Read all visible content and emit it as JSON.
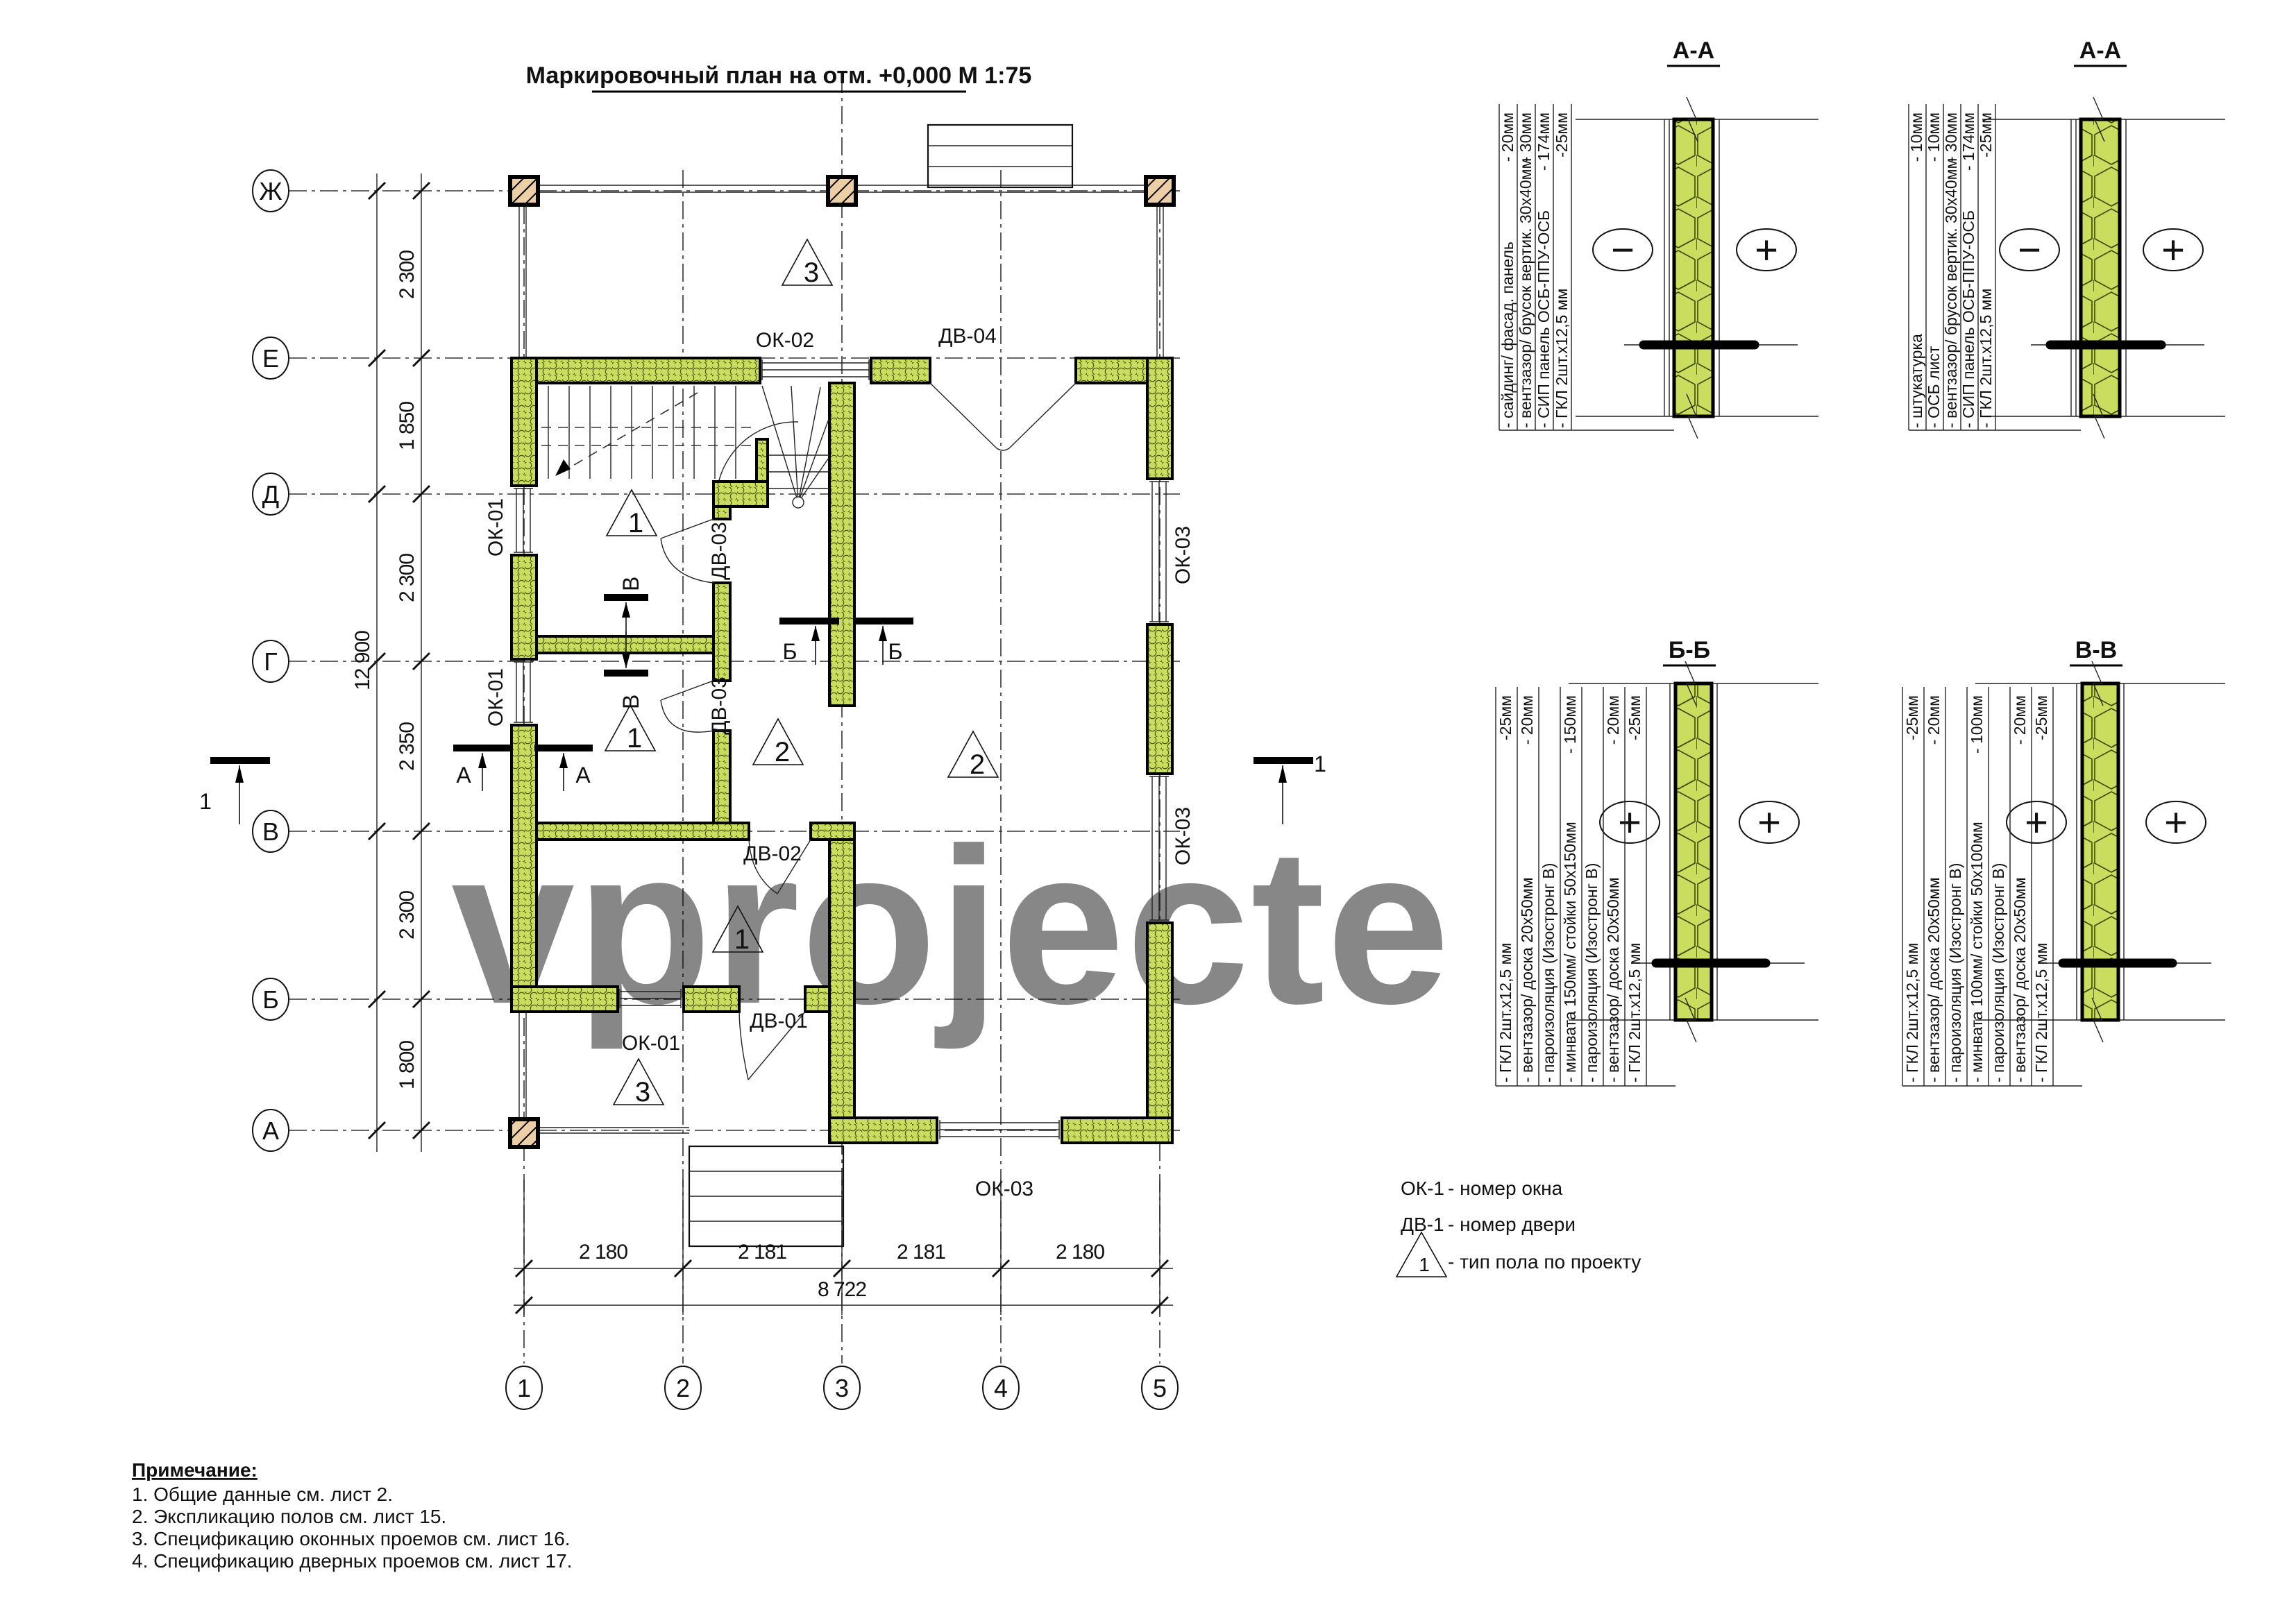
{
  "title": "Маркировочный план на отм. +0,000 М 1:75",
  "watermark": "vprojecte",
  "colors": {
    "wall_green": "#cbdd5e",
    "wall_hatch": "#44520a",
    "label_blue": "#7079b0",
    "wood_tan": "#eccfa6",
    "watermark_gray": "#cdcdcd"
  },
  "plan": {
    "axis_letters": [
      "Ж",
      "Е",
      "Д",
      "Г",
      "В",
      "Б",
      "А"
    ],
    "axis_numbers": [
      "1",
      "2",
      "3",
      "4",
      "5"
    ],
    "dims_left": [
      "2 300",
      "1 850",
      "2 300",
      "2 350",
      "2 300",
      "1 800"
    ],
    "dim_left_total": "12 900",
    "dims_bottom": [
      "2 180",
      "2 181",
      "2 181",
      "2 180"
    ],
    "dim_bottom_total": "8 722",
    "openings": {
      "ok02": "ОК-02",
      "dv04": "ДВ-04",
      "ok01_top": "ОК-01",
      "ok01_mid": "ОК-01",
      "ok01_bottom": "ОК-01",
      "dv03_top": "ДВ-03",
      "dv03_bottom": "ДВ-03",
      "ok03_top": "ОК-03",
      "ok03_mid": "ОК-03",
      "ok03_bottom": "ОК-03",
      "dv02": "ДВ-02",
      "dv01": "ДВ-01"
    },
    "floor_markers": {
      "porch_top": "3",
      "room_nw": "1",
      "room_w": "1",
      "room_mid": "2",
      "hall": "1",
      "room_e": "2",
      "porch_bottom": "3"
    },
    "section_cut_labels": {
      "v_upper": "В",
      "v_lower": "В",
      "b_left": "Б",
      "b_right": "Б",
      "a_left": "А",
      "a_right": "А",
      "one_left": "1",
      "one_right": "1"
    }
  },
  "sections": [
    {
      "title": "А-А",
      "sign_left": "−",
      "sign_right": "+",
      "layers": [
        {
          "name": "- сайдинг/ фасад. панель",
          "value": "- 20мм"
        },
        {
          "name": "- вентзазор/ брусок вертик. 30х40мм",
          "value": "- 30мм"
        },
        {
          "name": "- СИП панель ОСБ-ППУ-ОСБ",
          "value": "- 174мм"
        },
        {
          "name": "- ГКЛ 2шт.х12,5 мм",
          "value": "-25мм"
        }
      ]
    },
    {
      "title": "А-А",
      "sign_left": "−",
      "sign_right": "+",
      "layers": [
        {
          "name": "- штукатурка",
          "value": "- 10мм"
        },
        {
          "name": "- ОСБ лист",
          "value": "- 10мм"
        },
        {
          "name": "- вентзазор/ брусок вертик. 30х40мм",
          "value": "- 30мм"
        },
        {
          "name": "- СИП панель ОСБ-ППУ-ОСБ",
          "value": "- 174мм"
        },
        {
          "name": "- ГКЛ 2шт.х12,5 мм",
          "value": "-25мм"
        }
      ]
    },
    {
      "title": "Б-Б",
      "sign_left": "+",
      "sign_right": "+",
      "layers": [
        {
          "name": "- ГКЛ 2шт.х12,5 мм",
          "value": "-25мм"
        },
        {
          "name": "- вентзазор/ доска 20х50мм",
          "value": "- 20мм"
        },
        {
          "name": "- пароизоляция (Изостронг В)",
          "value": ""
        },
        {
          "name": "- минвата 150мм/ стойки 50х150мм",
          "value": "- 150мм"
        },
        {
          "name": "- пароизоляция (Изостронг В)",
          "value": ""
        },
        {
          "name": "- вентзазор/ доска 20х50мм",
          "value": "- 20мм"
        },
        {
          "name": "- ГКЛ 2шт.х12,5 мм",
          "value": "-25мм"
        }
      ]
    },
    {
      "title": "В-В",
      "sign_left": "+",
      "sign_right": "+",
      "layers": [
        {
          "name": "- ГКЛ 2шт.х12,5 мм",
          "value": "-25мм"
        },
        {
          "name": "- вентзазор/ доска 20х50мм",
          "value": "- 20мм"
        },
        {
          "name": "- пароизоляция (Изостронг В)",
          "value": ""
        },
        {
          "name": "- минвата 100мм/ стойки 50х100мм",
          "value": "- 100мм"
        },
        {
          "name": "- пароизоляция (Изостронг В)",
          "value": ""
        },
        {
          "name": "- вентзазор/ доска 20х50мм",
          "value": "- 20мм"
        },
        {
          "name": "- ГКЛ 2шт.х12,5 мм",
          "value": "-25мм"
        }
      ]
    }
  ],
  "legend": {
    "window_code": "ОК-1",
    "window_desc": "- номер окна",
    "door_code": "ДВ-1",
    "door_desc": "- номер двери",
    "floor_code": "1",
    "floor_desc": "- тип пола по проекту"
  },
  "notes": {
    "heading": "Примечание:",
    "items": [
      "1. Общие данные см. лист 2.",
      "2. Экспликацию полов см. лист 15.",
      "3. Спецификацию оконных проемов см. лист 16.",
      "4. Спецификацию дверных проемов см. лист 17."
    ]
  }
}
